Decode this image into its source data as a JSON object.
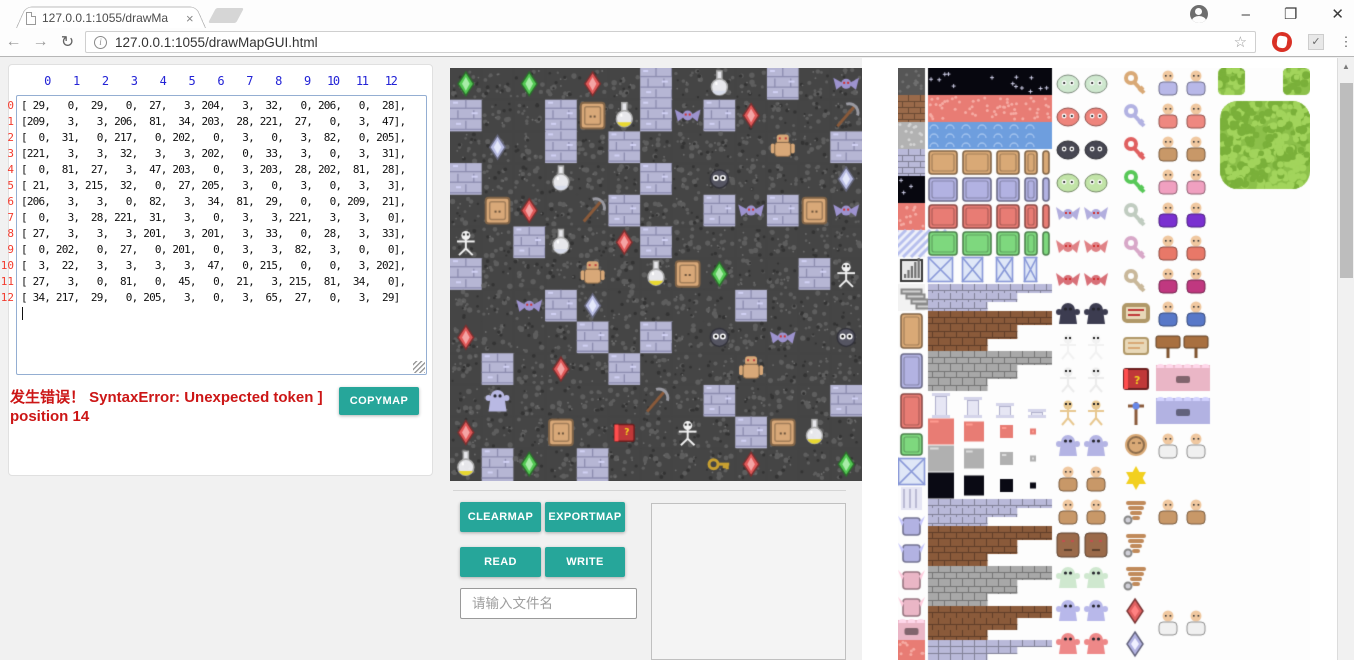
{
  "browser": {
    "tab": {
      "title": "127.0.0.1:1055/drawMa",
      "close": "×"
    },
    "window": {
      "minimize": "–",
      "restore": "❐",
      "close": "✕"
    },
    "toolbar": {
      "back": "←",
      "forward": "→",
      "reload": "↻",
      "info": "i",
      "url": "127.0.0.1:1055/drawMapGUI.html",
      "star": "☆",
      "check": "✓",
      "dots": "⋮",
      "scroll_up": "▲"
    }
  },
  "panel": {
    "col_header_line": "    0    1    2    3    4    5    6    7    8    9   10   11   12",
    "row_header_lines": "0\n1\n2\n3\n4\n5\n6\n7\n8\n9\n10\n11\n12",
    "matrix_display": "[ 29,   0,  29,   0,  27,   3, 204,   3,  32,   0, 206,   0,  28],\n[209,   3,   3, 206,  81,  34, 203,  28, 221,  27,   0,   3,  47],\n[  0,  31,   0, 217,   0, 202,   0,   3,   0,   3,  82,   0, 205],\n[221,   3,   3,  32,   3,   3, 202,   0,  33,   3,   0,   3,  31],\n[  0,  81,  27,   3,  47, 203,   0,   3, 203,  28, 202,  81,  28],\n[ 21,   3, 215,  32,   0,  27, 205,   3,   0,   3,   0,   3,   3],\n[206,   3,   3,   0,  82,   3,  34,  81,  29,   0,   0, 209,  21],\n[  0,   3,  28, 221,  31,   3,   0,   3,   3, 221,   3,   3,   0],\n[ 27,   3,   3,   3, 201,   3, 201,   3,  33,   0,  28,   3,  33],\n[  0, 202,   0,  27,   0, 201,   0,   3,   3,  82,   3,   0,   0],\n[  3,  22,   3,   3,   3,   3,  47,   0, 215,   0,   0,   3, 202],\n[ 27,   3,   0,  81,   0,  45,   0,  21,   3, 215,  81,  34,   0],\n[ 34, 217,  29,   0, 205,   3,   0,   3,  65,  27,   0,   3,  29]",
    "error_text": "发生错误！ SyntaxError: Unexpected token ] position 14",
    "copymap": "COPYMAP"
  },
  "controls": {
    "clearmap": "CLEARMAP",
    "exportmap": "EXPORTMAP",
    "read": "READ",
    "write": "WRITE",
    "filename_placeholder": "请输入文件名"
  },
  "map": {
    "rows": 13,
    "cols": 13,
    "matrix": [
      [
        29,
        0,
        29,
        0,
        27,
        3,
        204,
        3,
        32,
        0,
        206,
        0,
        28
      ],
      [
        209,
        3,
        3,
        206,
        81,
        34,
        203,
        28,
        221,
        27,
        0,
        3,
        47
      ],
      [
        0,
        31,
        0,
        217,
        0,
        202,
        0,
        3,
        0,
        3,
        82,
        0,
        205
      ],
      [
        221,
        3,
        3,
        32,
        3,
        3,
        202,
        0,
        33,
        3,
        0,
        3,
        31
      ],
      [
        0,
        81,
        27,
        3,
        47,
        203,
        0,
        3,
        203,
        28,
        202,
        81,
        28
      ],
      [
        21,
        3,
        215,
        32,
        0,
        27,
        205,
        3,
        0,
        3,
        0,
        3,
        3
      ],
      [
        206,
        3,
        3,
        0,
        82,
        3,
        34,
        81,
        29,
        0,
        0,
        209,
        21
      ],
      [
        0,
        3,
        28,
        221,
        31,
        3,
        0,
        3,
        3,
        221,
        3,
        3,
        0
      ],
      [
        27,
        3,
        3,
        3,
        201,
        3,
        201,
        3,
        33,
        0,
        28,
        3,
        33
      ],
      [
        0,
        202,
        0,
        27,
        0,
        201,
        0,
        3,
        3,
        82,
        3,
        0,
        0
      ],
      [
        3,
        22,
        3,
        3,
        3,
        3,
        47,
        0,
        215,
        0,
        0,
        3,
        202
      ],
      [
        27,
        3,
        0,
        81,
        0,
        45,
        0,
        21,
        3,
        215,
        81,
        34,
        0
      ],
      [
        34,
        217,
        29,
        0,
        205,
        3,
        0,
        3,
        65,
        27,
        0,
        3,
        29
      ]
    ],
    "floor_codes": [
      0,
      3
    ],
    "brick_threshold": 200,
    "colors": {
      "floor": "#454545",
      "floor_speck": "#5e5e5e",
      "brick": "#b6b6d4",
      "mortar": "#8d8db0"
    },
    "sprites": {
      "21": {
        "kind": "skeleton",
        "color": "#f2f2f2"
      },
      "22": {
        "kind": "ghost",
        "color": "#b9b9e3"
      },
      "27": {
        "kind": "gem",
        "color": "#e05858",
        "hi": "#f4a4a4"
      },
      "28": {
        "kind": "bat",
        "color": "#9d93cf"
      },
      "29": {
        "kind": "gem",
        "color": "#52c852",
        "hi": "#a8eca8"
      },
      "31": {
        "kind": "gem",
        "color": "#b9bde4",
        "hi": "#e4e8fa"
      },
      "32": {
        "kind": "flask",
        "color": "#d8dcea"
      },
      "33": {
        "kind": "blob",
        "color": "#555562"
      },
      "34": {
        "kind": "flask",
        "color": "#e8d830"
      },
      "45": {
        "kind": "book",
        "color": "#c03838"
      },
      "47": {
        "kind": "pickaxe",
        "color": "#8a5a3a"
      },
      "65": {
        "kind": "key",
        "color": "#c8a030"
      },
      "81": {
        "kind": "door",
        "color": "#d8a878"
      },
      "82": {
        "kind": "golem",
        "color": "#d8a878"
      }
    }
  },
  "palette": {
    "tile": 27,
    "items": [
      {
        "t": "flat",
        "x": 0,
        "y": 0,
        "w": 27,
        "h": 27,
        "c": "#565656",
        "c2": "#707070"
      },
      {
        "t": "brick",
        "x": 0,
        "y": 27,
        "w": 27,
        "h": 27,
        "c": "#9a6a4a"
      },
      {
        "t": "flat",
        "x": 0,
        "y": 54,
        "w": 27,
        "h": 27,
        "c": "#b2b2b2",
        "c2": "#d4d4d4"
      },
      {
        "t": "brick",
        "x": 0,
        "y": 81,
        "w": 27,
        "h": 27,
        "c": "#b9b9d9"
      },
      {
        "t": "star",
        "x": 0,
        "y": 108,
        "w": 27,
        "h": 27
      },
      {
        "t": "flat",
        "x": 0,
        "y": 135,
        "w": 27,
        "h": 27,
        "c": "#e87c74",
        "c2": "#f6aca4"
      },
      {
        "t": "diag",
        "x": 0,
        "y": 162,
        "w": 27,
        "h": 27
      },
      {
        "t": "meter",
        "x": 0,
        "y": 189,
        "w": 27,
        "h": 27
      },
      {
        "t": "stairs",
        "x": 0,
        "y": 216,
        "w": 27,
        "h": 27
      },
      {
        "t": "door1",
        "x": 0,
        "y": 243,
        "w": 27,
        "h": 40,
        "c": "#d9a976"
      },
      {
        "t": "door1",
        "x": 0,
        "y": 283,
        "w": 27,
        "h": 40,
        "c": "#b2b2e2"
      },
      {
        "t": "door1",
        "x": 0,
        "y": 323,
        "w": 27,
        "h": 40,
        "c": "#e87c74"
      },
      {
        "t": "door1",
        "x": 0,
        "y": 363,
        "w": 27,
        "h": 27,
        "c": "#7ed87e"
      },
      {
        "t": "xpat1",
        "x": 0,
        "y": 390,
        "w": 27,
        "h": 27
      },
      {
        "t": "pillars1",
        "x": 0,
        "y": 417,
        "w": 27,
        "h": 27
      },
      {
        "t": "wingtile",
        "x": 0,
        "y": 444,
        "w": 27,
        "h": 27,
        "c": "#b2b2e2"
      },
      {
        "t": "wingtile",
        "x": 0,
        "y": 471,
        "w": 27,
        "h": 27,
        "c": "#b2b2e2"
      },
      {
        "t": "wingtile",
        "x": 0,
        "y": 498,
        "w": 27,
        "h": 27,
        "c": "#eab6c6"
      },
      {
        "t": "wingtile",
        "x": 0,
        "y": 525,
        "w": 27,
        "h": 27,
        "c": "#eab6c6"
      },
      {
        "t": "wall",
        "x": 0,
        "y": 552,
        "w": 27,
        "h": 20,
        "c": "#eab6c6"
      },
      {
        "t": "flat",
        "x": 0,
        "y": 572,
        "w": 27,
        "h": 20,
        "c": "#e87c74",
        "c2": "#f6aca4"
      },
      {
        "t": "star",
        "x": 30,
        "y": 0,
        "w": 124,
        "h": 27
      },
      {
        "t": "flat",
        "x": 30,
        "y": 27,
        "w": 124,
        "h": 27,
        "c": "#e87c74",
        "c2": "#f6aca4"
      },
      {
        "t": "water",
        "x": 30,
        "y": 54,
        "w": 124,
        "h": 27
      },
      {
        "t": "doors",
        "x": 30,
        "y": 81,
        "w": 124,
        "h": 27,
        "c": "#d9a976"
      },
      {
        "t": "doors",
        "x": 30,
        "y": 108,
        "w": 124,
        "h": 27,
        "c": "#b2b2e2"
      },
      {
        "t": "doors",
        "x": 30,
        "y": 135,
        "w": 124,
        "h": 27,
        "c": "#e87c74"
      },
      {
        "t": "doors",
        "x": 30,
        "y": 162,
        "w": 124,
        "h": 27,
        "c": "#7ed87e"
      },
      {
        "t": "xpat",
        "x": 30,
        "y": 189,
        "w": 124,
        "h": 27
      },
      {
        "t": "brickstep",
        "x": 30,
        "y": 216,
        "w": 124,
        "h": 27,
        "c": "#b9b9d9"
      },
      {
        "t": "brickstep",
        "x": 30,
        "y": 243,
        "w": 124,
        "h": 40,
        "c": "#8a5a3a"
      },
      {
        "t": "brickstep",
        "x": 30,
        "y": 283,
        "w": 124,
        "h": 40,
        "c": "#a8a8a8"
      },
      {
        "t": "pillars",
        "x": 30,
        "y": 323,
        "w": 124,
        "h": 27
      },
      {
        "t": "dim",
        "x": 30,
        "y": 350,
        "w": 124,
        "h": 27,
        "c": "#e87c74"
      },
      {
        "t": "dim",
        "x": 30,
        "y": 377,
        "w": 124,
        "h": 27,
        "c": "#b0b0b0"
      },
      {
        "t": "dim",
        "x": 30,
        "y": 404,
        "w": 124,
        "h": 27,
        "c": "#0a0a14"
      },
      {
        "t": "brickstep",
        "x": 30,
        "y": 431,
        "w": 124,
        "h": 27,
        "c": "#b9b9d9"
      },
      {
        "t": "brickstep",
        "x": 30,
        "y": 458,
        "w": 124,
        "h": 40,
        "c": "#8a5a3a"
      },
      {
        "t": "brickstep",
        "x": 30,
        "y": 498,
        "w": 124,
        "h": 40,
        "c": "#a8a8a8"
      },
      {
        "t": "brickstep",
        "x": 30,
        "y": 538,
        "w": 124,
        "h": 34,
        "c": "#8a5a3a"
      },
      {
        "t": "brickstep",
        "x": 30,
        "y": 572,
        "w": 124,
        "h": 20,
        "c": "#b9b9d9"
      },
      {
        "t": "pair",
        "k": "slime",
        "x": 158,
        "y": 0,
        "c": "#cfe8cf"
      },
      {
        "t": "pair",
        "k": "slime",
        "x": 158,
        "y": 33,
        "c": "#ee847c"
      },
      {
        "t": "pair",
        "k": "slime",
        "x": 158,
        "y": 66,
        "c": "#474752"
      },
      {
        "t": "pair",
        "k": "slime",
        "x": 158,
        "y": 99,
        "c": "#c2e4a8"
      },
      {
        "t": "pair",
        "k": "bat",
        "x": 158,
        "y": 132,
        "c": "#b2aede"
      },
      {
        "t": "pair",
        "k": "bat",
        "x": 158,
        "y": 165,
        "c": "#e08286"
      },
      {
        "t": "pair",
        "k": "bat",
        "x": 158,
        "y": 198,
        "c": "#d87078"
      },
      {
        "t": "pair",
        "k": "ghost",
        "x": 158,
        "y": 231,
        "c": "#3c3c50"
      },
      {
        "t": "pair",
        "k": "skel",
        "x": 158,
        "y": 264,
        "c": "#f2f2f2"
      },
      {
        "t": "pair",
        "k": "skel",
        "x": 158,
        "y": 297,
        "c": "#ececec"
      },
      {
        "t": "pair",
        "k": "skel",
        "x": 158,
        "y": 330,
        "c": "#e8c890"
      },
      {
        "t": "pair",
        "k": "ghost",
        "x": 158,
        "y": 363,
        "c": "#b4b4e4"
      },
      {
        "t": "pair",
        "k": "human",
        "x": 158,
        "y": 396,
        "c": "#c89868"
      },
      {
        "t": "pair",
        "k": "human",
        "x": 158,
        "y": 429,
        "c": "#c89868"
      },
      {
        "t": "pair",
        "k": "face",
        "x": 158,
        "y": 462,
        "c": "#9a6a4a"
      },
      {
        "t": "pair",
        "k": "ghost",
        "x": 158,
        "y": 495,
        "c": "#cfe8cf"
      },
      {
        "t": "pair",
        "k": "ghost",
        "x": 158,
        "y": 528,
        "c": "#b8b8ea"
      },
      {
        "t": "pair",
        "k": "ghost",
        "x": 158,
        "y": 561,
        "c": "#ee8888"
      },
      {
        "t": "key",
        "x": 226,
        "y": 0,
        "c": "#d9a976"
      },
      {
        "t": "key",
        "x": 226,
        "y": 33,
        "c": "#b2b2e2"
      },
      {
        "t": "key",
        "x": 226,
        "y": 66,
        "c": "#e06060"
      },
      {
        "t": "key",
        "x": 226,
        "y": 99,
        "c": "#58c858"
      },
      {
        "t": "key",
        "x": 226,
        "y": 132,
        "c": "#c0ccc0"
      },
      {
        "t": "key",
        "x": 226,
        "y": 165,
        "c": "#d8a8c8"
      },
      {
        "t": "key",
        "x": 226,
        "y": 198,
        "c": "#c9b89a"
      },
      {
        "t": "scroll",
        "x": 226,
        "y": 231,
        "c": "#c03838"
      },
      {
        "t": "scroll",
        "x": 226,
        "y": 264,
        "c": "#d9a976"
      },
      {
        "t": "book",
        "x": 226,
        "y": 297,
        "c": "#c03838"
      },
      {
        "t": "staffv",
        "x": 226,
        "y": 330,
        "c": "#8a5a3a"
      },
      {
        "t": "coin",
        "x": 226,
        "y": 363,
        "c": "#d9a976"
      },
      {
        "t": "star6",
        "x": 226,
        "y": 396,
        "c": "#f2d020"
      },
      {
        "t": "wing",
        "x": 226,
        "y": 429,
        "c": "#c08a5a"
      },
      {
        "t": "wing",
        "x": 226,
        "y": 462,
        "c": "#c08a5a"
      },
      {
        "t": "wing",
        "x": 226,
        "y": 495,
        "c": "#c08a5a"
      },
      {
        "t": "gem",
        "x": 226,
        "y": 528,
        "c": "#e06060"
      },
      {
        "t": "gem",
        "x": 226,
        "y": 561,
        "c": "#b2b2e2"
      },
      {
        "t": "pair",
        "k": "human",
        "x": 258,
        "y": 0,
        "c": "#b8b8e8"
      },
      {
        "t": "pair",
        "k": "human",
        "x": 258,
        "y": 33,
        "c": "#ee8880"
      },
      {
        "t": "pair",
        "k": "human",
        "x": 258,
        "y": 66,
        "c": "#c89868"
      },
      {
        "t": "pair",
        "k": "human",
        "x": 258,
        "y": 99,
        "c": "#f0a0c0"
      },
      {
        "t": "pair",
        "k": "human",
        "x": 258,
        "y": 132,
        "c": "#7a30d0"
      },
      {
        "t": "pair",
        "k": "human",
        "x": 258,
        "y": 165,
        "c": "#e87868"
      },
      {
        "t": "pair",
        "k": "human",
        "x": 258,
        "y": 198,
        "c": "#c03880"
      },
      {
        "t": "pair",
        "k": "human",
        "x": 258,
        "y": 231,
        "c": "#5878c8"
      },
      {
        "t": "pair",
        "k": "sign",
        "x": 258,
        "y": 264,
        "c": "#a87040"
      },
      {
        "t": "wall",
        "x": 258,
        "y": 297,
        "w": 54,
        "h": 26,
        "c": "#eab6c6"
      },
      {
        "t": "wall",
        "x": 258,
        "y": 330,
        "w": 54,
        "h": 26,
        "c": "#b2b2e2"
      },
      {
        "t": "pair",
        "k": "human",
        "x": 258,
        "y": 363,
        "c": "#f0f0f0"
      },
      {
        "t": "pair",
        "k": "human",
        "x": 258,
        "y": 429,
        "c": "#c89868"
      },
      {
        "t": "pair",
        "k": "human",
        "x": 258,
        "y": 540,
        "c": "#f0f0f0"
      },
      {
        "t": "bush",
        "x": 320,
        "y": 0,
        "w": 27,
        "h": 27
      },
      {
        "t": "bush",
        "x": 385,
        "y": 0,
        "w": 27,
        "h": 27
      },
      {
        "t": "bush",
        "x": 322,
        "y": 33,
        "w": 90,
        "h": 88
      }
    ]
  },
  "colors": {
    "teal": "#26a69a",
    "error": "#cc1616",
    "col_header": "#2323d6",
    "row_header": "#f23b2e",
    "page_bg": "#f1f1f1"
  }
}
